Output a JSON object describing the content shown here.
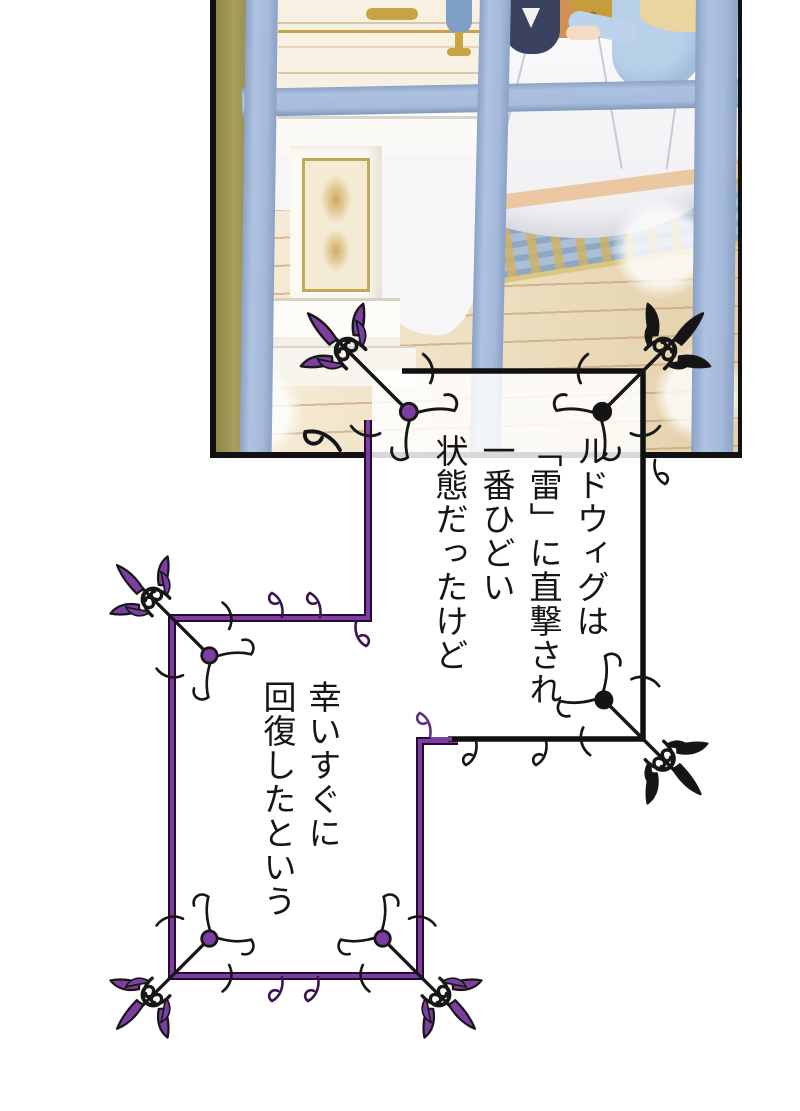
{
  "page": {
    "background_color": "#ffffff"
  },
  "illustration_panel": {
    "border_color": "#111111",
    "window_frame_color": "#a9bede",
    "left_wall_color": "#a29a58",
    "scene_colors": {
      "floor": "#efdcb4",
      "rug": "#abc0d6",
      "rug_trim": "#dcc67f",
      "bedding": "#f6f6f8",
      "bed_hem": "#ecc8a2",
      "gold_trim": "#c69c3d",
      "marble": "#fcfaf4",
      "accent_wall": "#cf9254",
      "navy_figure": "#3b4260",
      "blue_figure": "#b9d0e9",
      "blonde_hair": "#e9d59d"
    }
  },
  "captions": {
    "first": {
      "text": "ルドウィグは\n「雷」に直撃され\n一番ひどい\n状態だったけど",
      "frame_color": "#141414",
      "corner_accent_color": "#7c3fa1"
    },
    "second": {
      "text": "幸いすぐに\n回復したという",
      "frame_color": "#7c3fa1"
    }
  }
}
